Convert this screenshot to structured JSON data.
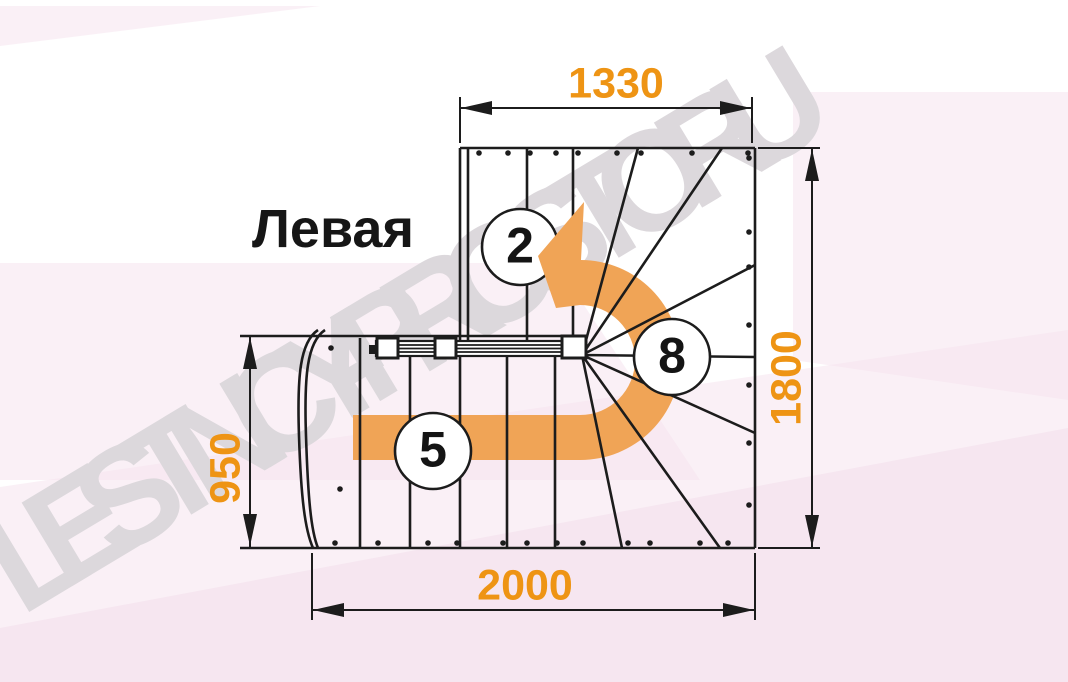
{
  "title": "Левая",
  "watermark": "LESTNICY-PROSTO.RU",
  "dimensions": {
    "top_width": "1330",
    "right_height": "1800",
    "left_height": "950",
    "bottom_width": "2000"
  },
  "flights": {
    "top_flight_steps": "2",
    "winder_steps": "8",
    "bottom_flight_steps": "5"
  },
  "colors": {
    "dimension": "#ee9414",
    "arrow": "#f0a456",
    "line": "#1c1c1c",
    "watermark": "#dcd8dc",
    "background_pink": "#f5e4ee"
  }
}
